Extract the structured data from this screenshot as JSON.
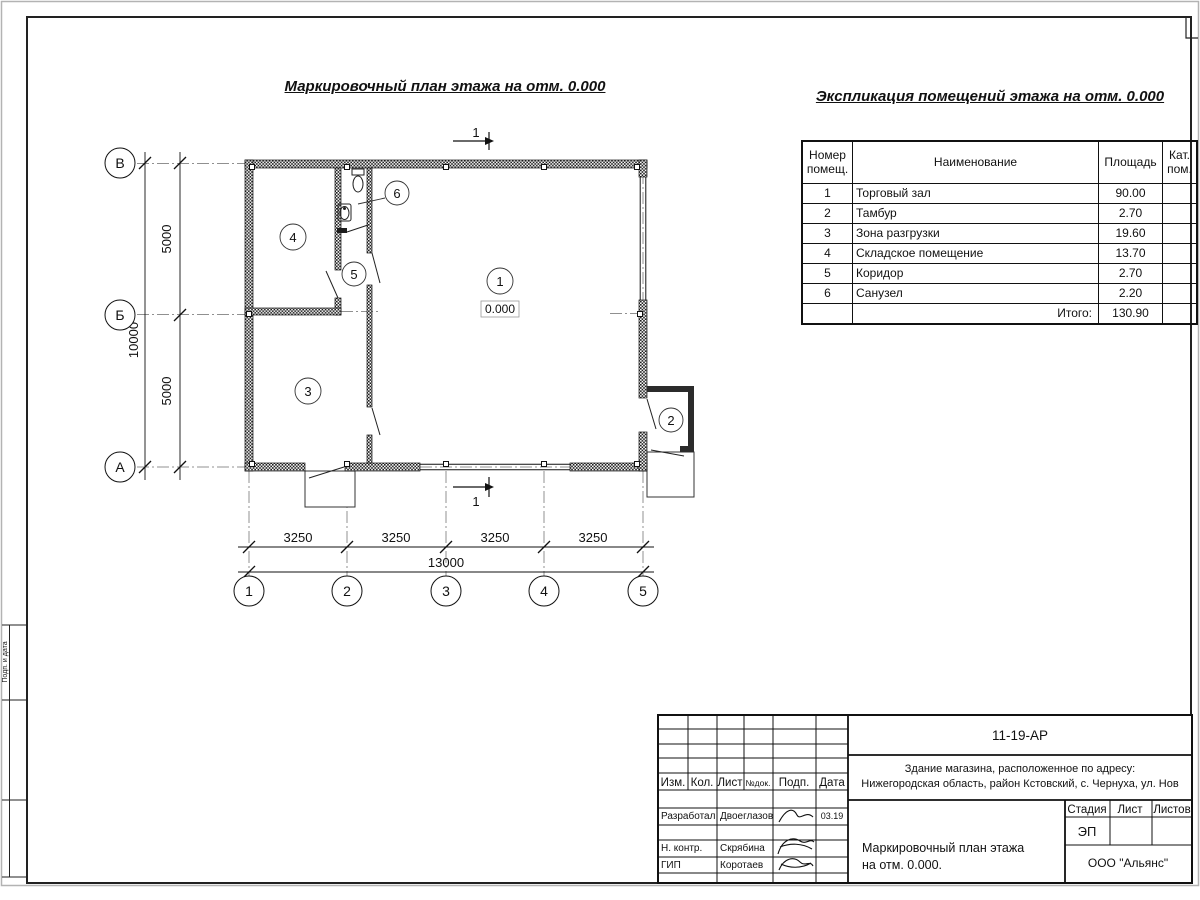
{
  "sheet": {
    "side_stamp_label": "Подп. и дата"
  },
  "plan": {
    "title": "Маркировочный план этажа на отм. 0.000",
    "section_label": "1",
    "elevation": "0.000",
    "axis_letters": [
      "В",
      "Б",
      "А"
    ],
    "axis_numbers": [
      "1",
      "2",
      "3",
      "4",
      "5"
    ],
    "dim_v1": "5000",
    "dim_v2": "5000",
    "dim_v_total": "10000",
    "dim_h1": "3250",
    "dim_h2": "3250",
    "dim_h3": "3250",
    "dim_h4": "3250",
    "dim_h_total": "13000",
    "room_labels": {
      "r1": "1",
      "r2": "2",
      "r3": "3",
      "r4": "4",
      "r5": "5",
      "r6": "6"
    }
  },
  "explication": {
    "title": "Экспликация помещений этажа на отм. 0.000",
    "headers": {
      "num": "Номер помещ.",
      "name": "Наименование",
      "area": "Площадь",
      "cat": "Кат. пом."
    },
    "rows": [
      {
        "num": "1",
        "name": "Торговый зал",
        "area": "90.00"
      },
      {
        "num": "2",
        "name": "Тамбур",
        "area": "2.70"
      },
      {
        "num": "3",
        "name": "Зона разгрузки",
        "area": "19.60"
      },
      {
        "num": "4",
        "name": "Складское помещение",
        "area": "13.70"
      },
      {
        "num": "5",
        "name": "Коридор",
        "area": "2.70"
      },
      {
        "num": "6",
        "name": "Санузел",
        "area": "2.20"
      }
    ],
    "total_label": "Итого:",
    "total_value": "130.90"
  },
  "titleblock": {
    "doc_number": "11-19-АР",
    "address_line1": "Здание магазина, расположенное по адресу:",
    "address_line2": "Нижегородская область, район Кстовский, с. Чернуха, ул. Нов",
    "col_izm": "Изм.",
    "col_kol": "Кол.",
    "col_list": "Лист",
    "col_ndoc": "№док.",
    "col_podp": "Подп.",
    "col_data": "Дата",
    "row_razrab_label": "Разработал",
    "row_razrab_name": "Двоеглазов",
    "row_razrab_date": "03.19",
    "row_nkontr_label": "Н. контр.",
    "row_nkontr_name": "Скрябина",
    "row_gip_label": "ГИП",
    "row_gip_name": "Коротаев",
    "stage_label": "Стадия",
    "list_label": "Лист",
    "listov_label": "Листов",
    "stage_value": "ЭП",
    "drawing_name_line1": "Маркировочный план этажа",
    "drawing_name_line2": "на отм. 0.000.",
    "company": "ООО \"Альянс\""
  }
}
